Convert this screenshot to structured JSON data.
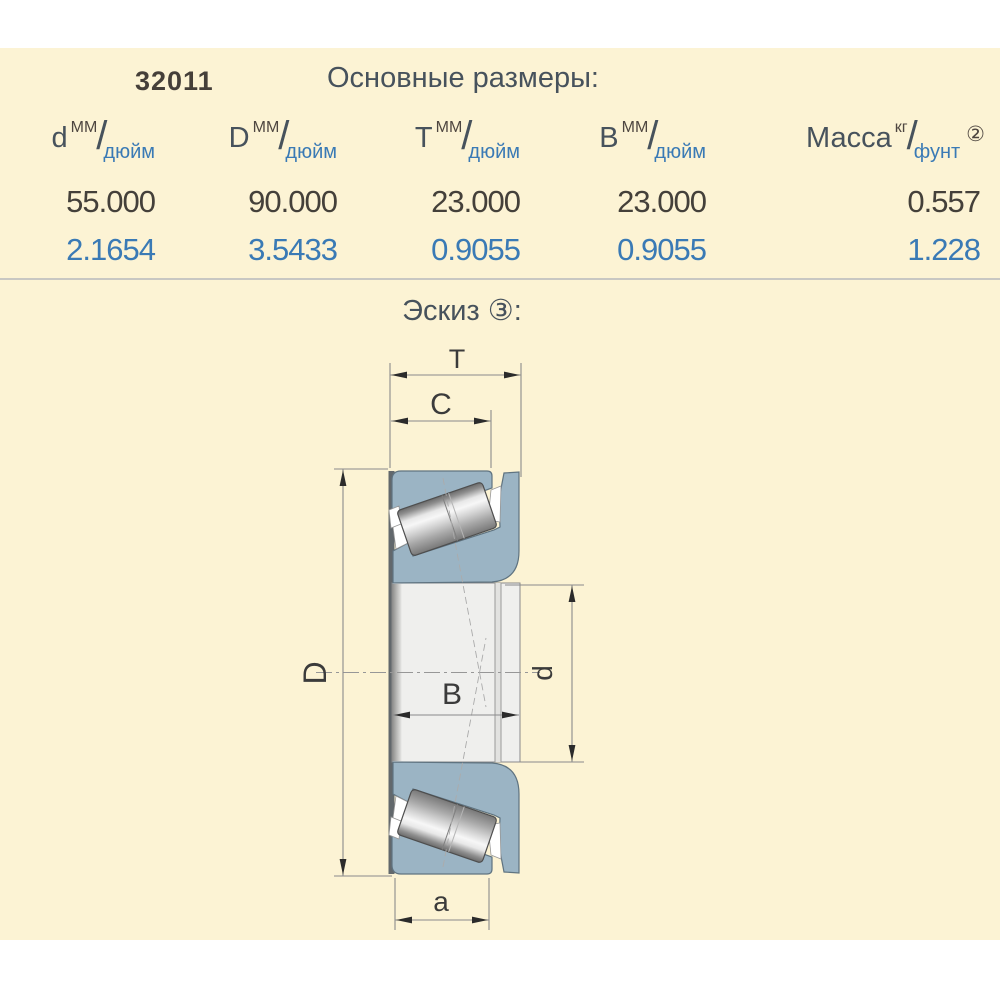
{
  "panel": {
    "code": "32011",
    "title": "Основные размеры:"
  },
  "table": {
    "columns": [
      {
        "symbol": "d",
        "unit_top": "ММ",
        "unit_bottom": "дюйм",
        "note": ""
      },
      {
        "symbol": "D",
        "unit_top": "ММ",
        "unit_bottom": "дюйм",
        "note": ""
      },
      {
        "symbol": "T",
        "unit_top": "ММ",
        "unit_bottom": "дюйм",
        "note": ""
      },
      {
        "symbol": "B",
        "unit_top": "ММ",
        "unit_bottom": "дюйм",
        "note": ""
      },
      {
        "symbol": "Масса",
        "unit_top": "кг",
        "unit_bottom": "фунт",
        "note": "②"
      }
    ],
    "mm_values": [
      "55.000",
      "90.000",
      "23.000",
      "23.000",
      "0.557"
    ],
    "inch_values": [
      "2.1654",
      "3.5433",
      "0.9055",
      "0.9055",
      "1.228"
    ]
  },
  "sketch": {
    "title": "Эскиз ③:",
    "labels": {
      "T": "T",
      "C": "C",
      "D": "D",
      "B": "B",
      "d": "d",
      "a": "a"
    }
  },
  "colors": {
    "panel_bg": "#FCF3D4",
    "accent_blue": "#3A7AB5",
    "dark_text": "#443F38",
    "slate_text": "#47525C",
    "ring_fill": "#9BB4C4",
    "ring_stroke": "#5F7380",
    "divider": "#C8C7C2"
  }
}
